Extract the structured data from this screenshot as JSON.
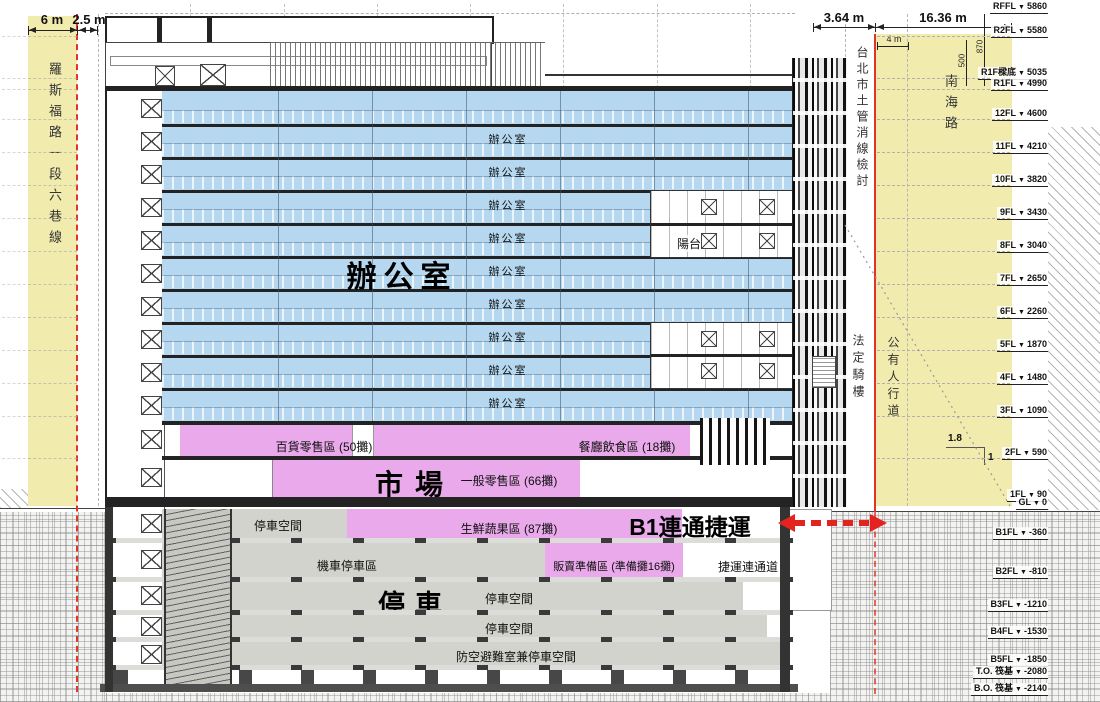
{
  "dimensions": {
    "left_6m": "6 m",
    "left_2_5m": "2.5 m",
    "right_3_64m": "3.64 m",
    "right_16_36m": "16.36 m",
    "right_4m": "4 m",
    "v_500": "500",
    "v_870": "870",
    "slope_run": "1.8",
    "slope_rise": "1"
  },
  "roads": {
    "left_road": "羅斯福路一段六巷線",
    "right_road": "南海路",
    "review_line": "台北市土管消線檢討",
    "arcade": "法定騎樓",
    "sidewalk": "公有人行道"
  },
  "levels": [
    {
      "name": "RFFL",
      "value": 5860,
      "label": "5860"
    },
    {
      "name": "R2FL",
      "value": 5580,
      "label": "5580"
    },
    {
      "name": "R1F樑底",
      "value": 5035,
      "label": "5035",
      "dy": -4
    },
    {
      "name": "R1FL",
      "value": 4990,
      "label": "4990",
      "dy": 3
    },
    {
      "name": "12FL",
      "value": 4600,
      "label": "4600"
    },
    {
      "name": "11FL",
      "value": 4210,
      "label": "4210"
    },
    {
      "name": "10FL",
      "value": 3820,
      "label": "3820"
    },
    {
      "name": "9FL",
      "value": 3430,
      "label": "3430"
    },
    {
      "name": "8FL",
      "value": 3040,
      "label": "3040"
    },
    {
      "name": "7FL",
      "value": 2650,
      "label": "2650"
    },
    {
      "name": "6FL",
      "value": 2260,
      "label": "2260"
    },
    {
      "name": "5FL",
      "value": 1870,
      "label": "1870"
    },
    {
      "name": "4FL",
      "value": 1480,
      "label": "1480"
    },
    {
      "name": "3FL",
      "value": 1090,
      "label": "1090"
    },
    {
      "name": "2FL",
      "value": 590,
      "label": "590"
    },
    {
      "name": "1FL",
      "value": 90,
      "label": "90"
    },
    {
      "name": "GL",
      "value": 0,
      "label": "0"
    },
    {
      "name": "B1FL",
      "value": -360,
      "label": "-360"
    },
    {
      "name": "B2FL",
      "value": -810,
      "label": "-810"
    },
    {
      "name": "B3FL",
      "value": -1210,
      "label": "-1210"
    },
    {
      "name": "B4FL",
      "value": -1530,
      "label": "-1530"
    },
    {
      "name": "B5FL",
      "value": -1850,
      "label": "-1850"
    },
    {
      "name": "T.O. 筏基",
      "value": -2080,
      "label": "-2080",
      "dy": -7
    },
    {
      "name": "B.O. 筏基",
      "value": -2140,
      "label": "-2140",
      "dy": 5
    }
  ],
  "zones": {
    "office_big": "辦公室",
    "office_floor": "辦公室",
    "office_floor_count": 9,
    "balcony": "陽台",
    "market_big": "市場",
    "dept_retail": "百貨零售區 (50攤)",
    "restaurant": "餐廳飲食區 (18攤)",
    "general_retail": "一般零售區 (66攤)",
    "fresh_produce": "生鮮蔬果區 (87攤)",
    "b1_mrt": "B1連通捷運",
    "vendor_prep": "販賣準備區 (準備攤16攤)",
    "mrt_passage": "捷運連通道",
    "parking_big": "停車",
    "parking_space": "停車空間",
    "moto_parking": "機車停車區",
    "shelter_parking": "防空避難室兼停車空間"
  },
  "colors": {
    "office": "#b5d8f0",
    "market": "#eaa9ea",
    "parking": "#d3d3cd",
    "road_zone": "#f1ecae",
    "redline": "#e23328",
    "arrow": "#e22320"
  }
}
